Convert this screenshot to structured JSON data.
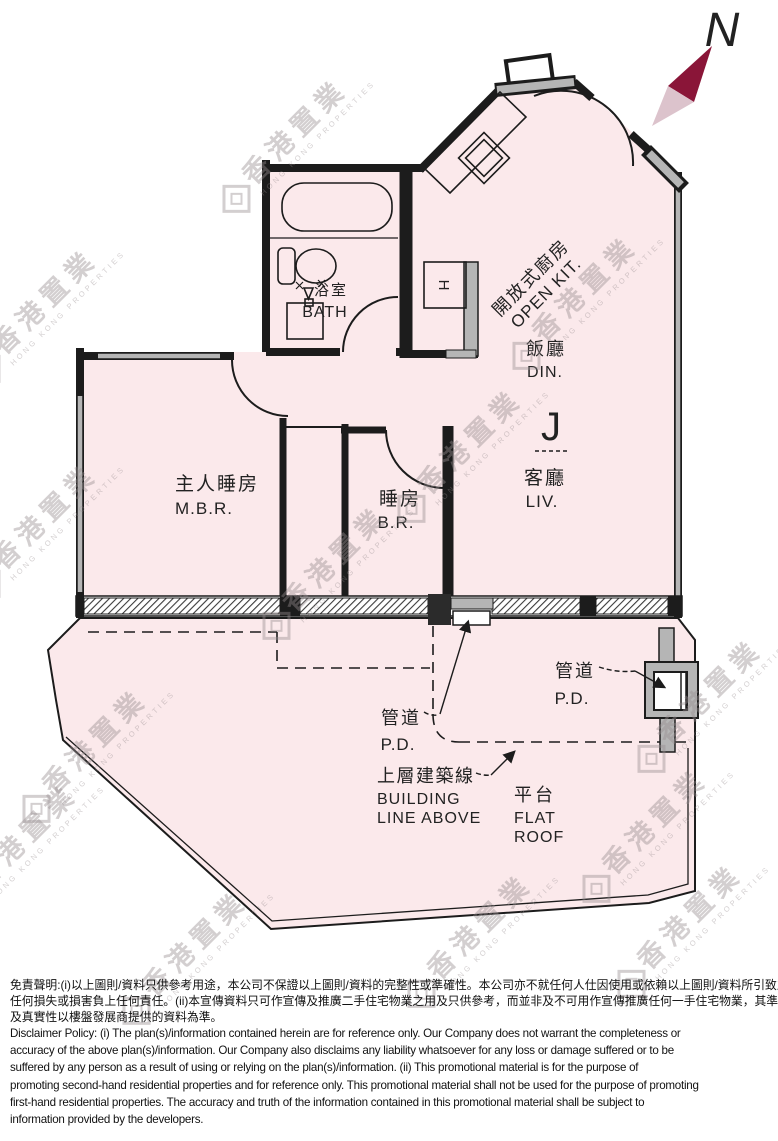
{
  "compass": {
    "label": "N"
  },
  "watermark": {
    "cn": "香港置業",
    "en": "HONG KONG PROPERTIES"
  },
  "rooms": {
    "bath": {
      "cn": "浴室",
      "en": "BATH"
    },
    "open_kitchen": {
      "cn": "開放式廚房",
      "en": "OPEN KIT."
    },
    "dining": {
      "cn": "飯廳",
      "en": "DIN."
    },
    "living": {
      "cn": "客廳",
      "en": "LIV."
    },
    "master_bedroom": {
      "cn": "主人睡房",
      "en": "M.B.R."
    },
    "bedroom": {
      "cn": "睡房",
      "en": "B.R."
    },
    "pipe_duct": {
      "cn": "管道",
      "en": "P.D."
    },
    "building_line": {
      "cn": "上層建築線",
      "en_line1": "BUILDING",
      "en_line2": "LINE ABOVE"
    },
    "flat_roof": {
      "cn": "平台",
      "en_line1": "FLAT",
      "en_line2": "ROOF"
    }
  },
  "symbols": {
    "living_hook": "J",
    "kitchen_h": "H"
  },
  "colors": {
    "plan_fill": "#fbe9eb",
    "wall": "#1c1c1c",
    "structural_gray": "#b5b5b5",
    "compass_dark": "#8a1538",
    "compass_light": "#dcc3cc",
    "watermark_gray": "#b7afb1"
  },
  "disclaimer": {
    "chinese_lines": [
      "免責聲明:(i)以上圖則/資料只供參考用途，本公司不保證以上圖則/資料的完整性或準確性。本公司亦不就任何人仕因使用或依賴以上圖則/資料所引致之",
      "任何損失或損害負上任何責任。(ii)本宣傳資料只可作宣傳及推廣二手住宅物業之用及只供參考，而並非及不可用作宣傳推廣任何一手住宅物業，其準確性",
      "及真實性以樓盤發展商提供的資料為準。"
    ],
    "english_lines": [
      "Disclaimer Policy: (i) The plan(s)/information contained herein are for reference only. Our Company does not warrant the completeness or",
      "accuracy of the above plan(s)/information. Our Company also disclaims any liability whatsoever for any loss or damage suffered or to be",
      "suffered by any person as a result of using or relying on the plan(s)/information. (ii) This promotional material is for the purpose of",
      "promoting second-hand residential properties and for reference only. This promotional material shall not be used for the purpose of promoting",
      "first-hand residential properties. The accuracy and truth of the information contained in this promotional material shall be subject to",
      "information provided by the developers."
    ]
  }
}
